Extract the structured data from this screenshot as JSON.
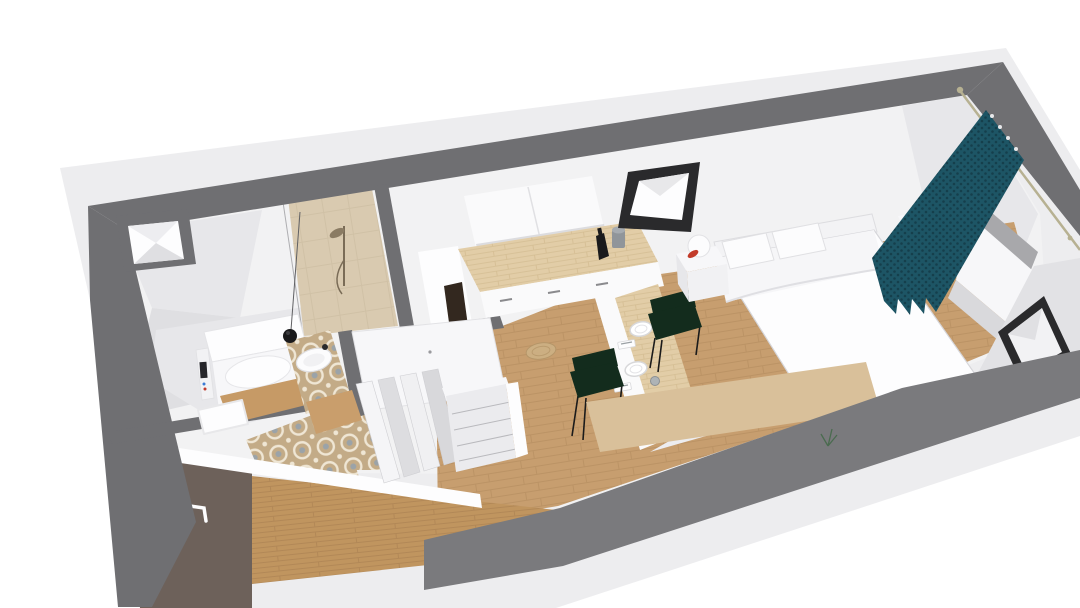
{
  "scene": {
    "type": "3d-floorplan-aerial-render",
    "rooms": [
      {
        "name": "bathroom"
      },
      {
        "name": "entry-hall"
      },
      {
        "name": "kitchen-dining"
      },
      {
        "name": "bedroom-living"
      }
    ],
    "objects": [
      "outer-walls",
      "roof-skylight-well",
      "shower",
      "shower-fixture",
      "toilet",
      "toilet-control-panel",
      "washbasin",
      "pendant-lamp",
      "bath-mat",
      "wood-vanity",
      "accordion-folding-door",
      "chest-of-drawers",
      "wardrobe-top",
      "kitchen-upper-cabinets",
      "kitchen-counter",
      "tall-cabinet",
      "bottle",
      "canister",
      "dining-island",
      "dinner-plates",
      "cups",
      "napkin-cutlery",
      "fruit-bowl",
      "dining-chair",
      "double-bed",
      "pillows",
      "headboard",
      "nightstand",
      "ball-lamp",
      "window-sill-box",
      "roof-window-back",
      "roof-window-right",
      "right-wall-window",
      "curtain",
      "curtain-rod",
      "sideboard",
      "plant-sprig",
      "entry-door",
      "door-handle",
      "floor-rug"
    ]
  },
  "colors": {
    "page_bg": "#ffffff",
    "apron": "#ededef",
    "wall_top_band": "#6f6f72",
    "bottom_band": "#7a7a7d",
    "wall_white": "#f2f2f3",
    "wall_bright": "#fafafb",
    "wall_shade": "#e7e7ea",
    "wall_shade2": "#dfdfe2",
    "roof_plane": "#e2e2e5",
    "floor_wood": "#c79e6f",
    "floor_wood_line": "#b08a5c",
    "wood_edge": "#c0955f",
    "wood_edge_line": "#a87f52",
    "counter_wood": "#e2cda7",
    "counter_wood_line": "#c9b184",
    "tile_base": "#c3ab87",
    "tile_motif": "#efe6d4",
    "tile_blue": "#97a2ac",
    "shower_tile": "#d9cab0",
    "shower_line": "#c8b89c",
    "door_brown": "#6d615a",
    "white": "#fdfdfe",
    "soft_gray": "#ededf0",
    "frame_black": "#2a2a2c",
    "glass_white": "#f7f7f9",
    "curtain": "#1d5565",
    "curtain_dark": "#153f4c",
    "chair_green": "#132c1d",
    "leg_black": "#1b1b1b",
    "metal_gray": "#93989c",
    "rod_tan": "#b7b192",
    "red": "#c23b2a",
    "yellow": "#e2b72e",
    "orange": "#d98b25",
    "plant_green": "#4a6b4f",
    "lamp_black": "#1a1a1c",
    "panel_dark": "#26262a",
    "stroke_soft": "#dcdcdf"
  }
}
